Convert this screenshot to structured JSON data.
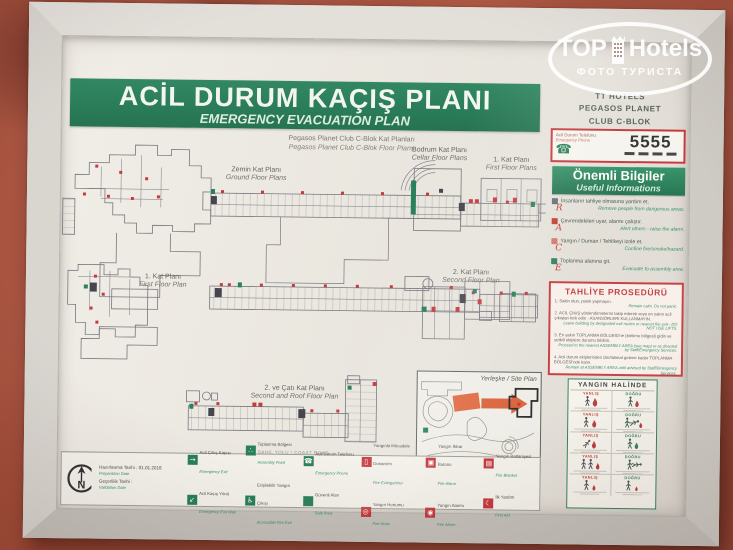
{
  "watermark": {
    "brand_left": "TOP",
    "brand_right": "Hotels",
    "tagline": "ФОТО ТУРИСТА"
  },
  "header": {
    "title_tr": "ACİL DURUM KAÇIŞ PLANI",
    "title_en": "EMERGENCY EVACUATION PLAN",
    "hotel_line1": "TT HOTELS",
    "hotel_line2": "PEGASOS PLANET",
    "hotel_line3": "CLUB C-BLOK",
    "subtitle_tr": "Pegasos Planet Club C-Blok Kat Planları",
    "subtitle_en": "Pegasos Planet Club C-Blok Floor Plans"
  },
  "plans": {
    "ground": {
      "tr": "Zemin Kat Planı",
      "en": "Ground Floor Plans"
    },
    "cellar": {
      "tr": "Bodrum Kat Planı",
      "en": "Cellar Floor Plans"
    },
    "first_small": {
      "tr": "1. Kat Planı",
      "en": "First Floor Plans"
    },
    "first": {
      "tr": "1. Kat Planı",
      "en": "First Floor Plan"
    },
    "second": {
      "tr": "2. Kat Planı",
      "en": "Second Floor Plan"
    },
    "second_roof": {
      "tr": "2. ve Çatı Kat Planı",
      "en": "Second and Roof Floor Plan"
    },
    "site_label": "Yerleşke / Site Plan",
    "coast_label": "SAHİL YOLU / COAST ROAD"
  },
  "sidebar": {
    "phone": {
      "label_tr": "Acil Durum Telefonu",
      "label_en": "Emergency Phone",
      "number": "5555",
      "phone_glyph": "☎"
    },
    "info": {
      "title_tr": "Önemli Bilgiler",
      "title_en": "Useful Informations",
      "items": [
        {
          "letter": "R",
          "tr": "İnsanların tahliye olmasına yardım et.",
          "en": "Remove people from dangerous areas."
        },
        {
          "letter": "A",
          "tr": "Çevrendekileri uyar, alarmı çalıştır.",
          "en": "Alert others - raise the alarm."
        },
        {
          "letter": "C",
          "tr": "Yangın / Duman / Tehlikeyi izole et.",
          "en": "Confine fire/smoke/hazard."
        },
        {
          "letter": "E",
          "tr": "Toplanma alanına git.",
          "en": "Evacuate to assembly area."
        }
      ]
    },
    "procedure": {
      "title": "TAHLİYE PROSEDÜRÜ",
      "steps": [
        {
          "tr": "1. Sakin olun, panik yapmayın.",
          "en": "Remain calm. Do not panic."
        },
        {
          "tr": "2. ACİL ÇIKIŞ yönlendirmelerini takip ederek veya en yakın acil çıkıştan terk edin - ASANSÖRLERİ KULLANMAYIN.",
          "en": "Leave building by designated exit routes or nearest fire exit - DO NOT USE LIFTS."
        },
        {
          "tr": "3. En yakın TOPLANMA BÖLGESİ'ne (birikme bölgesi) gidin ve yetkili ekiplere durumu bildirin.",
          "en": "Proceed to the nearest ASSEMBLY AREA (see map) or as directed by Staff/Emergency Services."
        },
        {
          "tr": "4. Acil durum ekiplerinden izin/talimat gelene kadar TOPLANMA BÖLGESİ'nde kalın.",
          "en": "Remain at ASSEMBLY AREA until advised by Staff/Emergency Services."
        }
      ]
    },
    "fire": {
      "title": "YANGIN HALİNDE",
      "wrong": "YANLIŞ",
      "right": "DOĞRU"
    }
  },
  "footer": {
    "compass": "N",
    "prepared": {
      "tr": "Hazırlanma Tarihi",
      "en": "Preparation Date",
      "value": "01.01.2018"
    },
    "valid": {
      "tr": "Geçerlilik Tarihi",
      "en": "Validation Date",
      "value": ""
    },
    "legend": [
      {
        "tr": "Acil Çıkış Kapısı",
        "en": "Emergency Exit",
        "glyph": "→"
      },
      {
        "tr": "Acil Kaçış Yönü",
        "en": "Emergency Exit Way",
        "glyph": "↙"
      },
      {
        "tr": "Toplanma Bölgesi",
        "en": "Assembly Point",
        "glyph": "∴"
      },
      {
        "tr": "Erişilebilir Yangın Çıkışı",
        "en": "Accessible Fire Exit",
        "glyph": "♿"
      },
      {
        "tr": "Acil Durum Telefonu",
        "en": "Emergency Phone",
        "glyph": "☎"
      },
      {
        "tr": "Güvenli Alan",
        "en": "Safe Area",
        "glyph": ""
      },
      {
        "tr": "Yangınla Mücadele Donanımı",
        "en": "Fire Extinguisher",
        "glyph": "▯"
      },
      {
        "tr": "Yangın Hortumu",
        "en": "Fire Hose",
        "glyph": "◎"
      },
      {
        "tr": "Yangın İhbar Butonu",
        "en": "Fire Alarm",
        "glyph": "▣"
      },
      {
        "tr": "Yangın Alarmı",
        "en": "Fire Alarm",
        "glyph": "◉"
      },
      {
        "tr": "Yangın Battaniyesi",
        "en": "Fire Blanket",
        "glyph": "▤"
      },
      {
        "tr": "İlk Yardım",
        "en": "First Aid",
        "glyph": "☾"
      }
    ]
  },
  "colors": {
    "green": "#1e7a52",
    "red": "#c13136",
    "english_italic": "#2e8b6a"
  }
}
